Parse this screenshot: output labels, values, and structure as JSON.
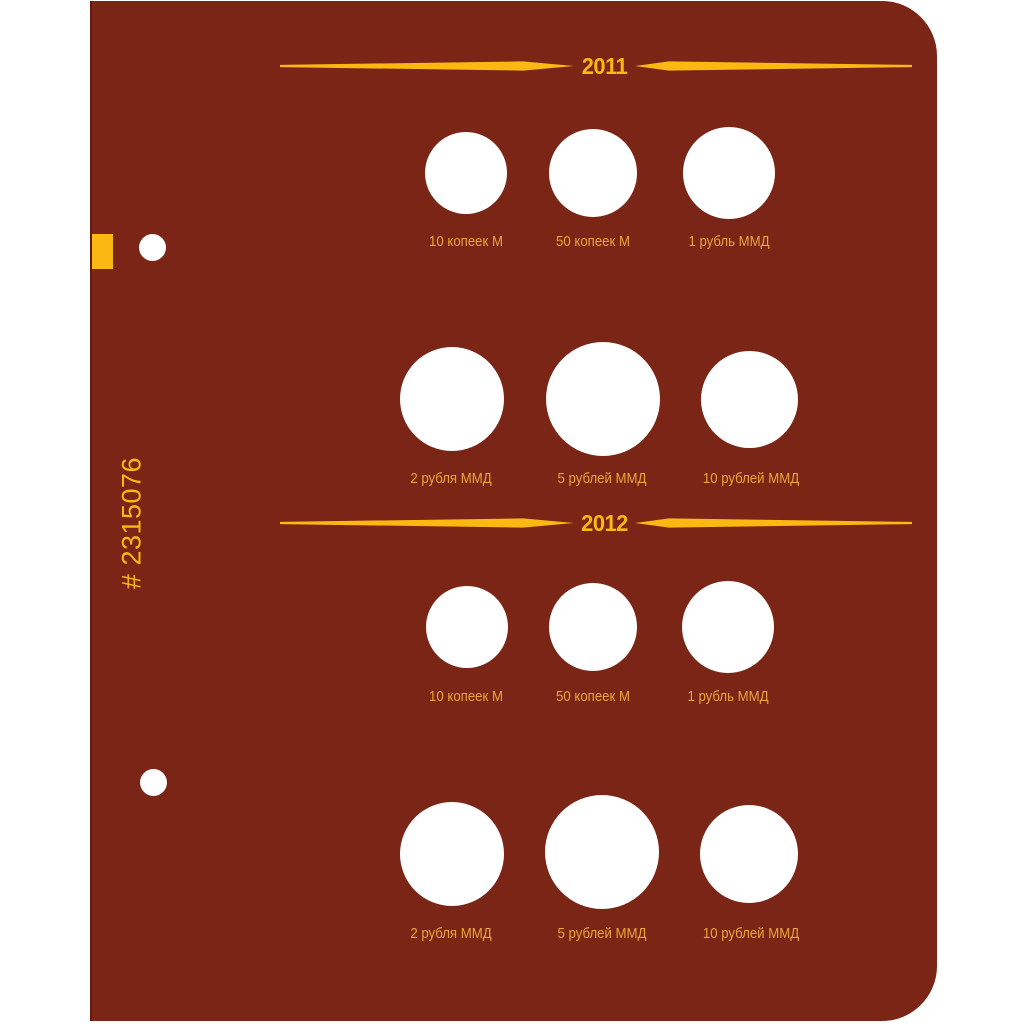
{
  "page": {
    "catalog_number": "# 2315076",
    "background_color": "#7B2517",
    "accent_gold": "#FBB813",
    "label_color": "#E9A43C",
    "slot_color": "#FFFFFF"
  },
  "sections": [
    {
      "year": "2011",
      "rows": [
        {
          "slots": [
            {
              "label": "10 копеек М"
            },
            {
              "label": "50 копеек М"
            },
            {
              "label": "1 рубль ММД"
            }
          ]
        },
        {
          "slots": [
            {
              "label": "2 рубля ММД"
            },
            {
              "label": "5 рублей ММД"
            },
            {
              "label": "10 рублей ММД"
            }
          ]
        }
      ]
    },
    {
      "year": "2012",
      "rows": [
        {
          "slots": [
            {
              "label": "10 копеек М"
            },
            {
              "label": "50 копеек М"
            },
            {
              "label": "1 рубль ММД"
            }
          ]
        },
        {
          "slots": [
            {
              "label": "2 рубля ММД"
            },
            {
              "label": "5 рублей ММД"
            },
            {
              "label": "10 рублей ММД"
            }
          ]
        }
      ]
    }
  ]
}
